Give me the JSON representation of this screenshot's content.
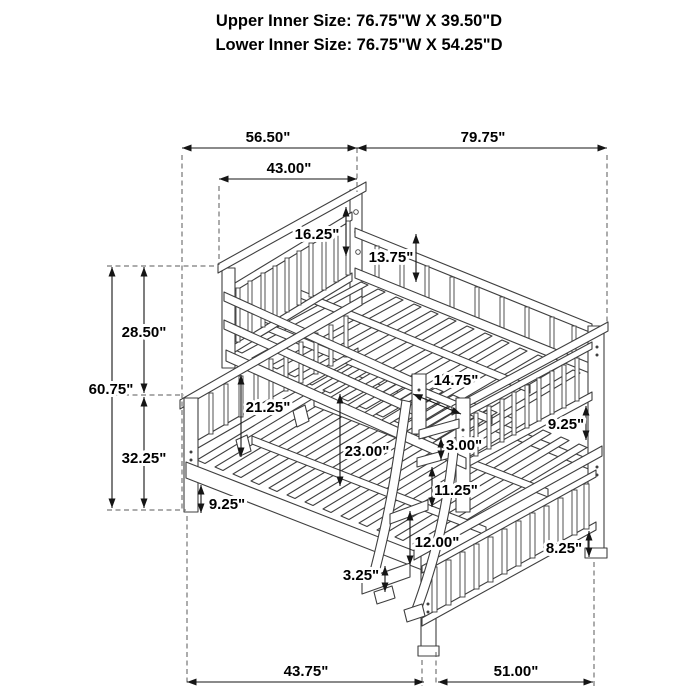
{
  "title": {
    "line1": "Upper Inner Size: 76.75\"W X 39.50\"D",
    "line2": "Lower Inner Size: 76.75\"W X 54.25\"D"
  },
  "dims": {
    "overall_depth": "56.50\"",
    "overall_length": "79.75\"",
    "upper_bunk_depth": "43.00\"",
    "upper_guard_height": "16.25\"",
    "upper_rail_to_deck": "13.75\"",
    "upper_section_height": "28.50\"",
    "overall_height": "60.75\"",
    "lower_section_height": "32.25\"",
    "lower_guard_height": "21.25\"",
    "under_bunk_clearance": "23.00\"",
    "ladder_opening_width": "14.75\"",
    "step_gap": "3.00\"",
    "upper_rung_spacing": "11.25\"",
    "side_rail_to_floor": "9.25\"",
    "upper_footboard_panel": "9.25\"",
    "lower_rung_spacing": "12.00\"",
    "bottom_step_height": "3.25\"",
    "lower_leg_height": "8.25\"",
    "lower_front_span": "43.75\"",
    "lower_side_span": "51.00\""
  },
  "colors": {
    "line_art": "#3f3f3f",
    "dimension": "#151515",
    "text": "#000000",
    "background": "#ffffff"
  }
}
